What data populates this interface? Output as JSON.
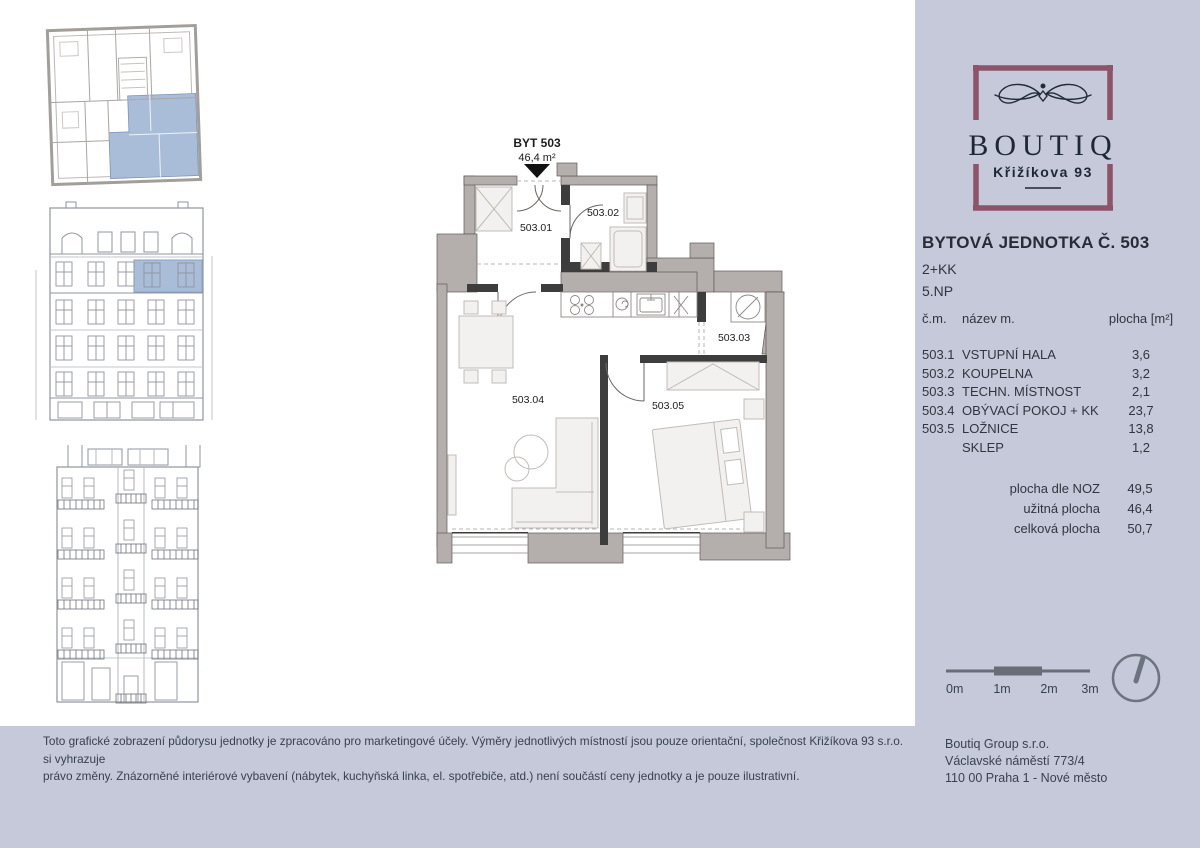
{
  "colors": {
    "accent_maroon": "#8d5368",
    "panel_lavender": "#c5c9da",
    "highlight_blue": "#a9bdd9"
  },
  "logo": {
    "brand": "BOUTIQ",
    "address_line": "Křižíkova 93"
  },
  "unit": {
    "title": "BYTOVÁ JEDNOTKA Č. 503",
    "layout": "2+KK",
    "floor": "5.NP"
  },
  "room_table": {
    "col_num": "č.m.",
    "col_name": "název m.",
    "col_area": "plocha [m²]",
    "rows": [
      {
        "num": "503.1",
        "name": "VSTUPNÍ HALA",
        "area": "3,6"
      },
      {
        "num": "503.2",
        "name": "KOUPELNA",
        "area": "3,2"
      },
      {
        "num": "503.3",
        "name": "TECHN. MÍSTNOST",
        "area": "2,1"
      },
      {
        "num": "503.4",
        "name": "OBÝVACÍ POKOJ + KK",
        "area": "23,7"
      },
      {
        "num": "503.5",
        "name": "LOŽNICE",
        "area": "13,8"
      },
      {
        "num": "",
        "name": "SKLEP",
        "area": "1,2"
      }
    ],
    "summary": [
      {
        "label": "plocha dle NOZ",
        "value": "49,5"
      },
      {
        "label": "užitná plocha",
        "value": "46,4"
      },
      {
        "label": "celková plocha",
        "value": "50,7"
      }
    ]
  },
  "floorplan": {
    "title": "BYT 503",
    "area": "46,4 m²",
    "rooms": {
      "r1": "503.01",
      "r2": "503.02",
      "r3": "503.03",
      "r4": "503.04",
      "r5": "503.05"
    }
  },
  "scale_bar": {
    "labels": [
      "0m",
      "1m",
      "2m",
      "3m"
    ]
  },
  "company": {
    "lines": [
      "Boutiq Group s.r.o.",
      "Václavské náměstí 773/4",
      "110 00 Praha 1 - Nové město"
    ]
  },
  "disclaimer": {
    "line1": "Toto grafické zobrazení půdorysu jednotky je zpracováno pro marketingové účely. Výměry jednotlivých místností jsou pouze orientační, společnost Křižíkova 93 s.r.o. si vyhrazuje",
    "line2": "právo změny. Znázorněné interiérové vybavení (nábytek, kuchyňská linka, el. spotřebiče, atd.) není součástí ceny jednotky a je pouze ilustrativní."
  }
}
